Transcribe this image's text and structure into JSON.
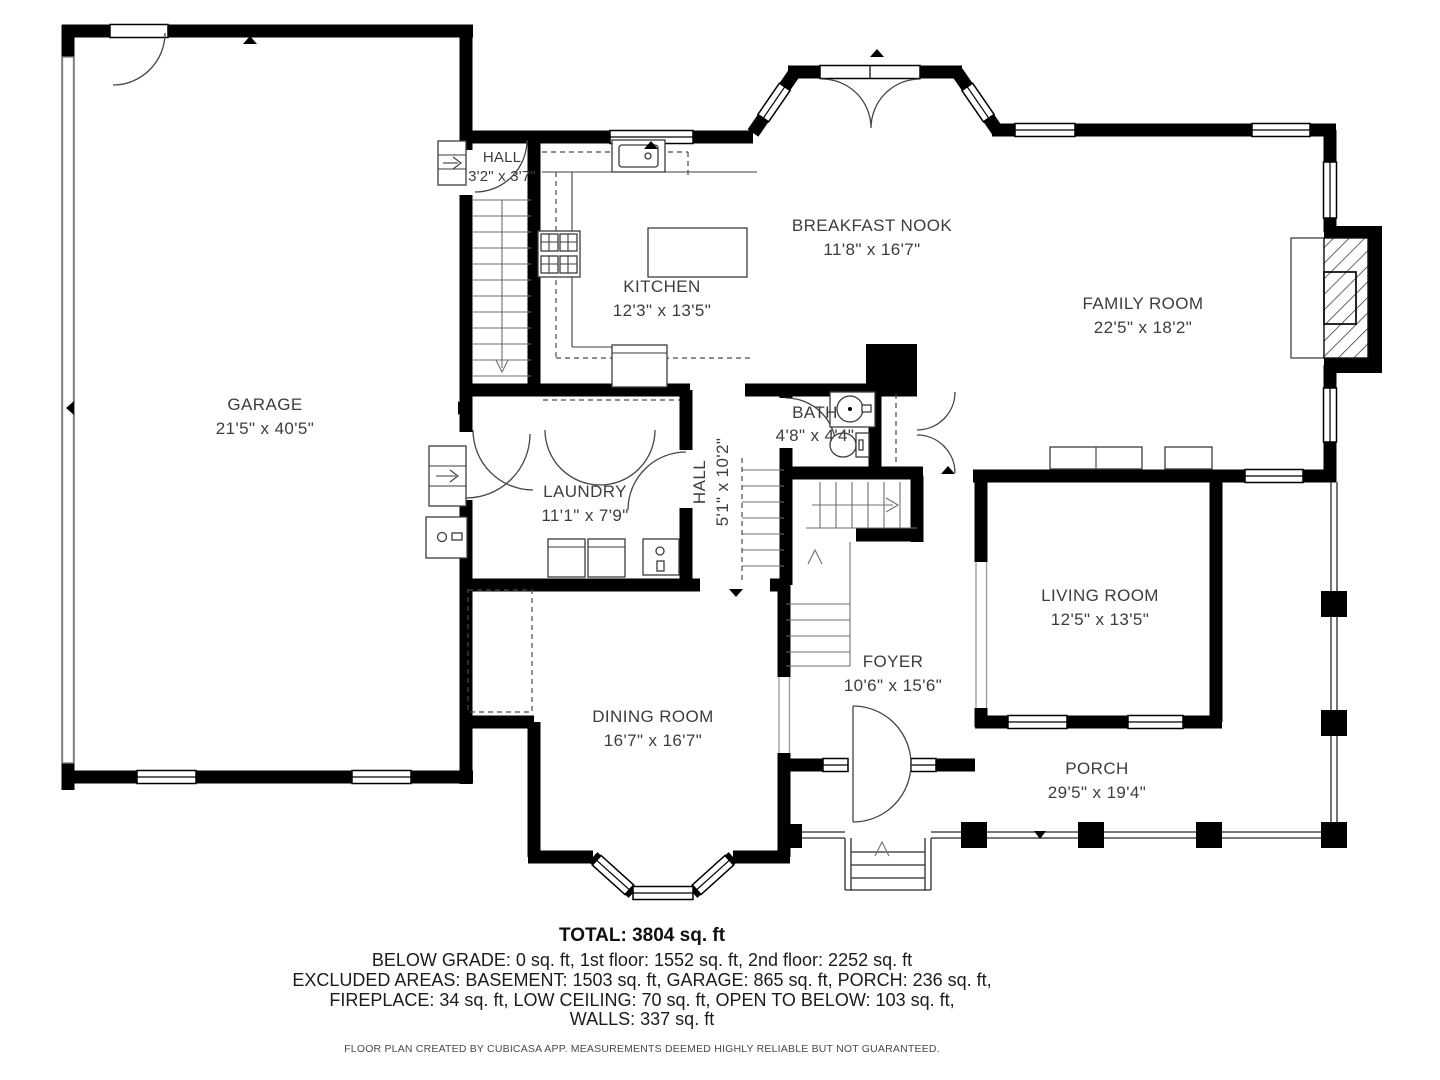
{
  "rooms": [
    {
      "name": "GARAGE",
      "dims": "21'5\" x 40'5\""
    },
    {
      "name": "HALL",
      "dims": "3'2\" x 3'7\""
    },
    {
      "name": "KITCHEN",
      "dims": "12'3\" x 13'5\""
    },
    {
      "name": "BREAKFAST NOOK",
      "dims": "11'8\" x 16'7\""
    },
    {
      "name": "FAMILY ROOM",
      "dims": "22'5\" x 18'2\""
    },
    {
      "name": "BATH",
      "dims": "4'8\" x 4'4\""
    },
    {
      "name": "HALL",
      "dims": "5'1\" x 10'2\""
    },
    {
      "name": "LAUNDRY",
      "dims": "11'1\" x 7'9\""
    },
    {
      "name": "LIVING ROOM",
      "dims": "12'5\" x 13'5\""
    },
    {
      "name": "FOYER",
      "dims": "10'6\" x 15'6\""
    },
    {
      "name": "DINING ROOM",
      "dims": "16'7\" x 16'7\""
    },
    {
      "name": "PORCH",
      "dims": "29'5\" x 19'4\""
    }
  ],
  "summary": {
    "total": "TOTAL: 3804 sq. ft",
    "line1": "BELOW GRADE: 0 sq. ft, 1st floor: 1552 sq. ft, 2nd floor: 2252 sq. ft",
    "line2": "EXCLUDED AREAS: BASEMENT: 1503 sq. ft, GARAGE: 865 sq. ft, PORCH: 236 sq. ft,",
    "line3": "FIREPLACE: 34 sq. ft, LOW CEILING: 70 sq. ft, OPEN TO BELOW: 103 sq. ft,",
    "line4": "WALLS: 337 sq. ft"
  },
  "disclaimer": "FLOOR PLAN CREATED BY CUBICASA APP. MEASUREMENTS DEEMED HIGHLY RELIABLE BUT NOT GUARANTEED.",
  "colors": {
    "wall": "#000000",
    "label_text": "#3d3d3d",
    "background": "#ffffff"
  }
}
